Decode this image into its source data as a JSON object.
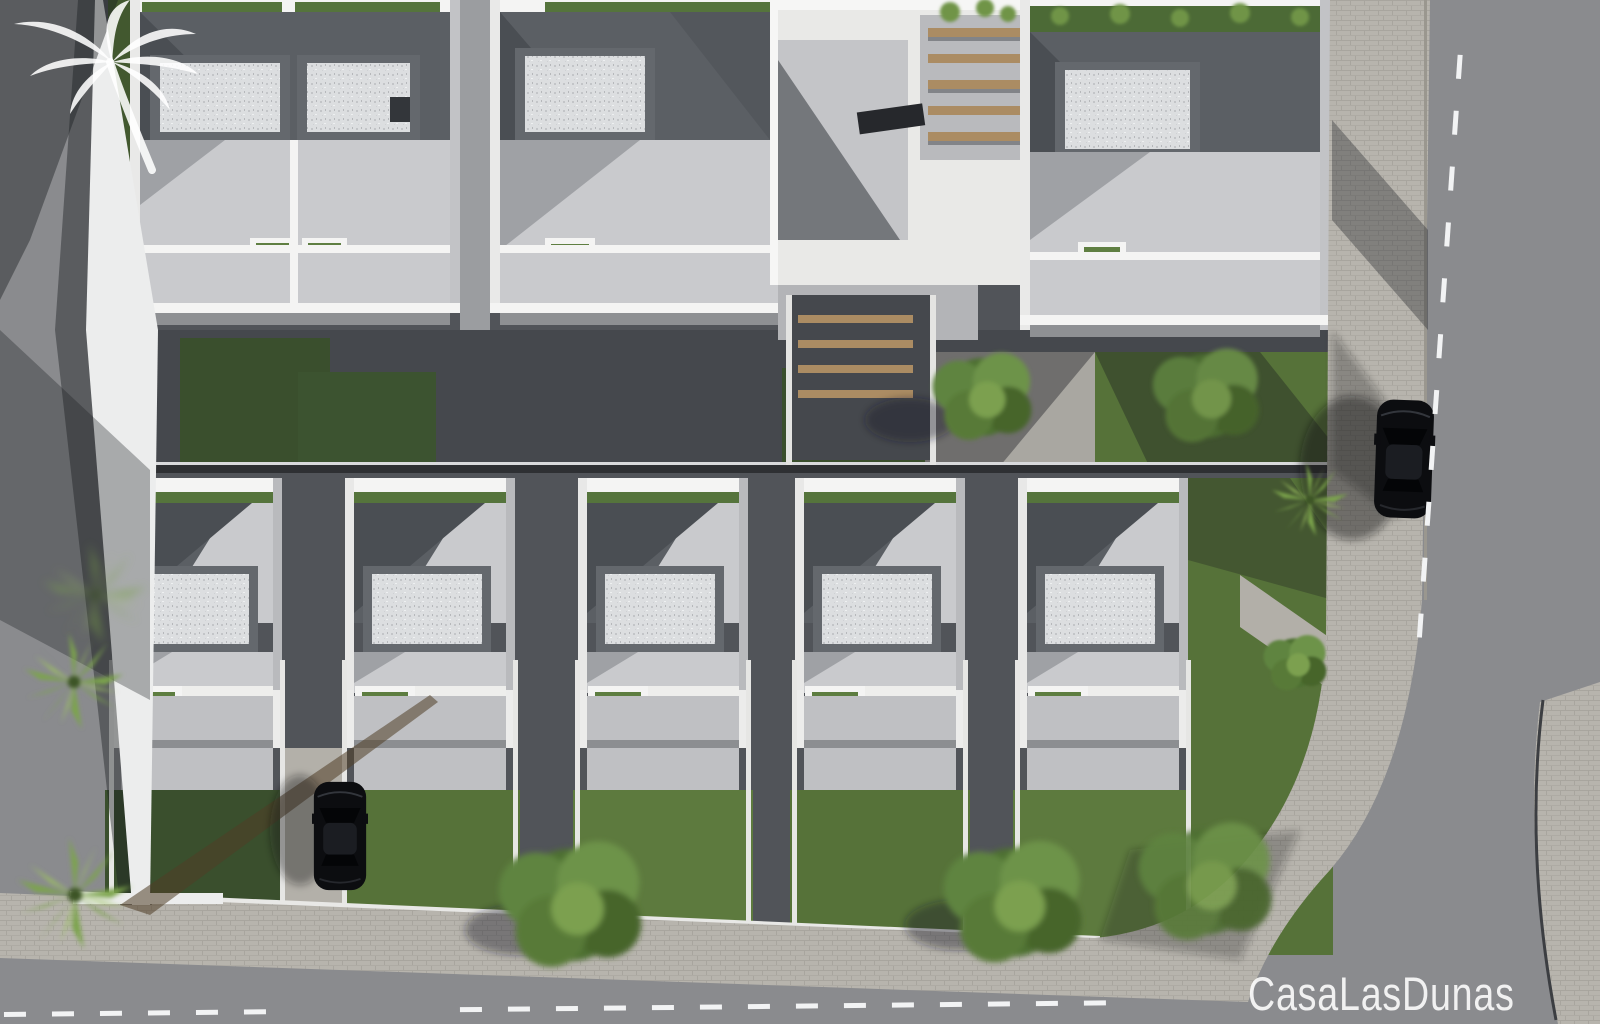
{
  "watermark": {
    "brand_text": "CasaLasDunas",
    "logo_icon": "palm-tree-icon"
  },
  "scene": {
    "description": "Aerial top-down 3D architectural render of a modern white villa development with flat roofs, roof terraces and gardens",
    "top_row_building_count": 4,
    "bottom_row_villa_count": 5,
    "car_count": 2,
    "cars": [
      {
        "color": "black",
        "location": "right road, parked at kerb"
      },
      {
        "color": "black",
        "location": "driveway between bottom-row villas"
      }
    ],
    "road_markings": "dashed white centre lines on bottom and right roads",
    "vegetation": [
      "palm trees",
      "garden trees",
      "shrubs",
      "lawns",
      "green roof strips",
      "balcony planters"
    ],
    "roof_features": [
      "gravel skylight boxes",
      "wooden pergola beams",
      "solar panel",
      "roof terraces",
      "stairwells with wooden treads"
    ]
  },
  "palette": {
    "road_asphalt": "#8a8b8e",
    "road_marking": "#f2f3f4",
    "sidewalk_pavement": "#b7b4ad",
    "sidewalk_line": "#a8a59e",
    "site_ground": "#515459",
    "courtyard_dark": "#45484d",
    "roof_dark": "#5b5f64",
    "roof_shadow": "#4a4e53",
    "terrace_light": "#c9cacd",
    "terrace_shadow": "#9fa1a5",
    "deck_white": "#e9e9e7",
    "wall_white": "#f4f4f3",
    "gravel_fill": "#dcdee0",
    "gravel_frame": "#64686d",
    "green_roof": "#55743c",
    "grass_bright": "#5d7a3e",
    "grass_mid": "#567239",
    "grass_dark": "#3a4f2d",
    "tree_green": "#4e7030",
    "palm_green": "#7ca44b",
    "wood_beam": "#ab8c63",
    "car_black": "#0c0d10",
    "curb_line": "#3c3e42",
    "shadow_tint": "rgba(25,28,32,0.42)",
    "watermark_white": "rgba(255,255,255,0.88)"
  }
}
